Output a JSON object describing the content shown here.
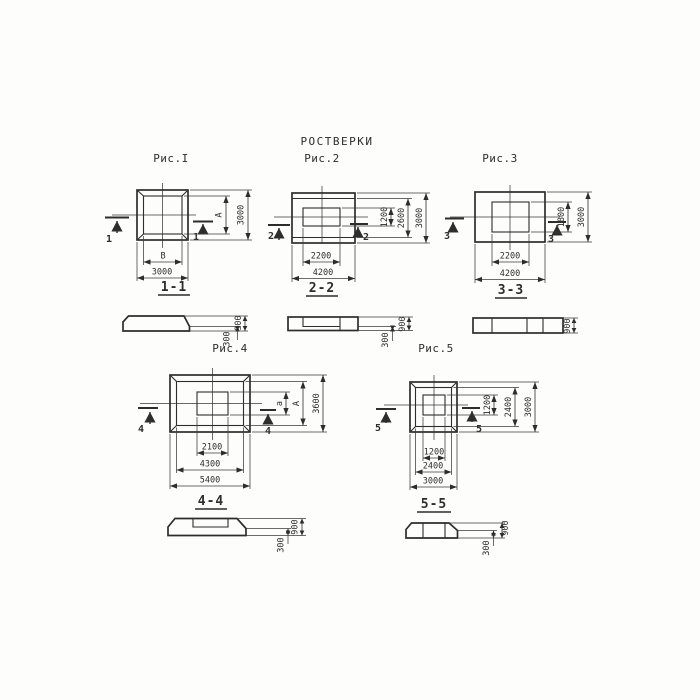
{
  "title": "РОСТВЕРКИ",
  "colors": {
    "ink": "#2d2d2d",
    "paper": "#fdfdfc"
  },
  "fig1": {
    "label": "Рис.I",
    "cut": "1",
    "section_label": "1-1",
    "dim_inner_width": "В",
    "dim_outer_width": "3000",
    "dim_inner_height": "А",
    "dim_outer_height": "3000"
  },
  "fig2": {
    "label": "Рис.2",
    "cut": "2",
    "section_label": "2-2",
    "dim_inner_width": "2200",
    "dim_outer_width": "4200",
    "dim_inner_height": "1200",
    "dim_mid_height": "2600",
    "dim_outer_height": "3000"
  },
  "fig3": {
    "label": "Рис.3",
    "cut": "3",
    "section_label": "3-3",
    "dim_inner_width": "2200",
    "dim_outer_width": "4200",
    "dim_inner_height": "1800",
    "dim_outer_height": "3000"
  },
  "fig4": {
    "label": "Рис.4",
    "cut": "4",
    "section_label": "4-4",
    "dim_recess_width": "2100",
    "dim_mid_width": "4300",
    "dim_outer_width": "5400",
    "dim_recess_height": "а",
    "dim_mid_height": "А",
    "dim_outer_height": "3600"
  },
  "fig5": {
    "label": "Рис.5",
    "cut": "5",
    "section_label": "5-5",
    "dim_recess_width": "1200",
    "dim_mid_width": "2400",
    "dim_outer_width": "3000",
    "dim_recess_height": "1200",
    "dim_mid_height": "2400",
    "dim_outer_height": "3000"
  },
  "sections": {
    "s1": {
      "height": "900",
      "step": "300"
    },
    "s2": {
      "height": "900",
      "step": "300"
    },
    "s3": {
      "height": "900"
    },
    "s4": {
      "height": "900",
      "step": "300"
    },
    "s5": {
      "height": "900",
      "step": "300"
    }
  }
}
